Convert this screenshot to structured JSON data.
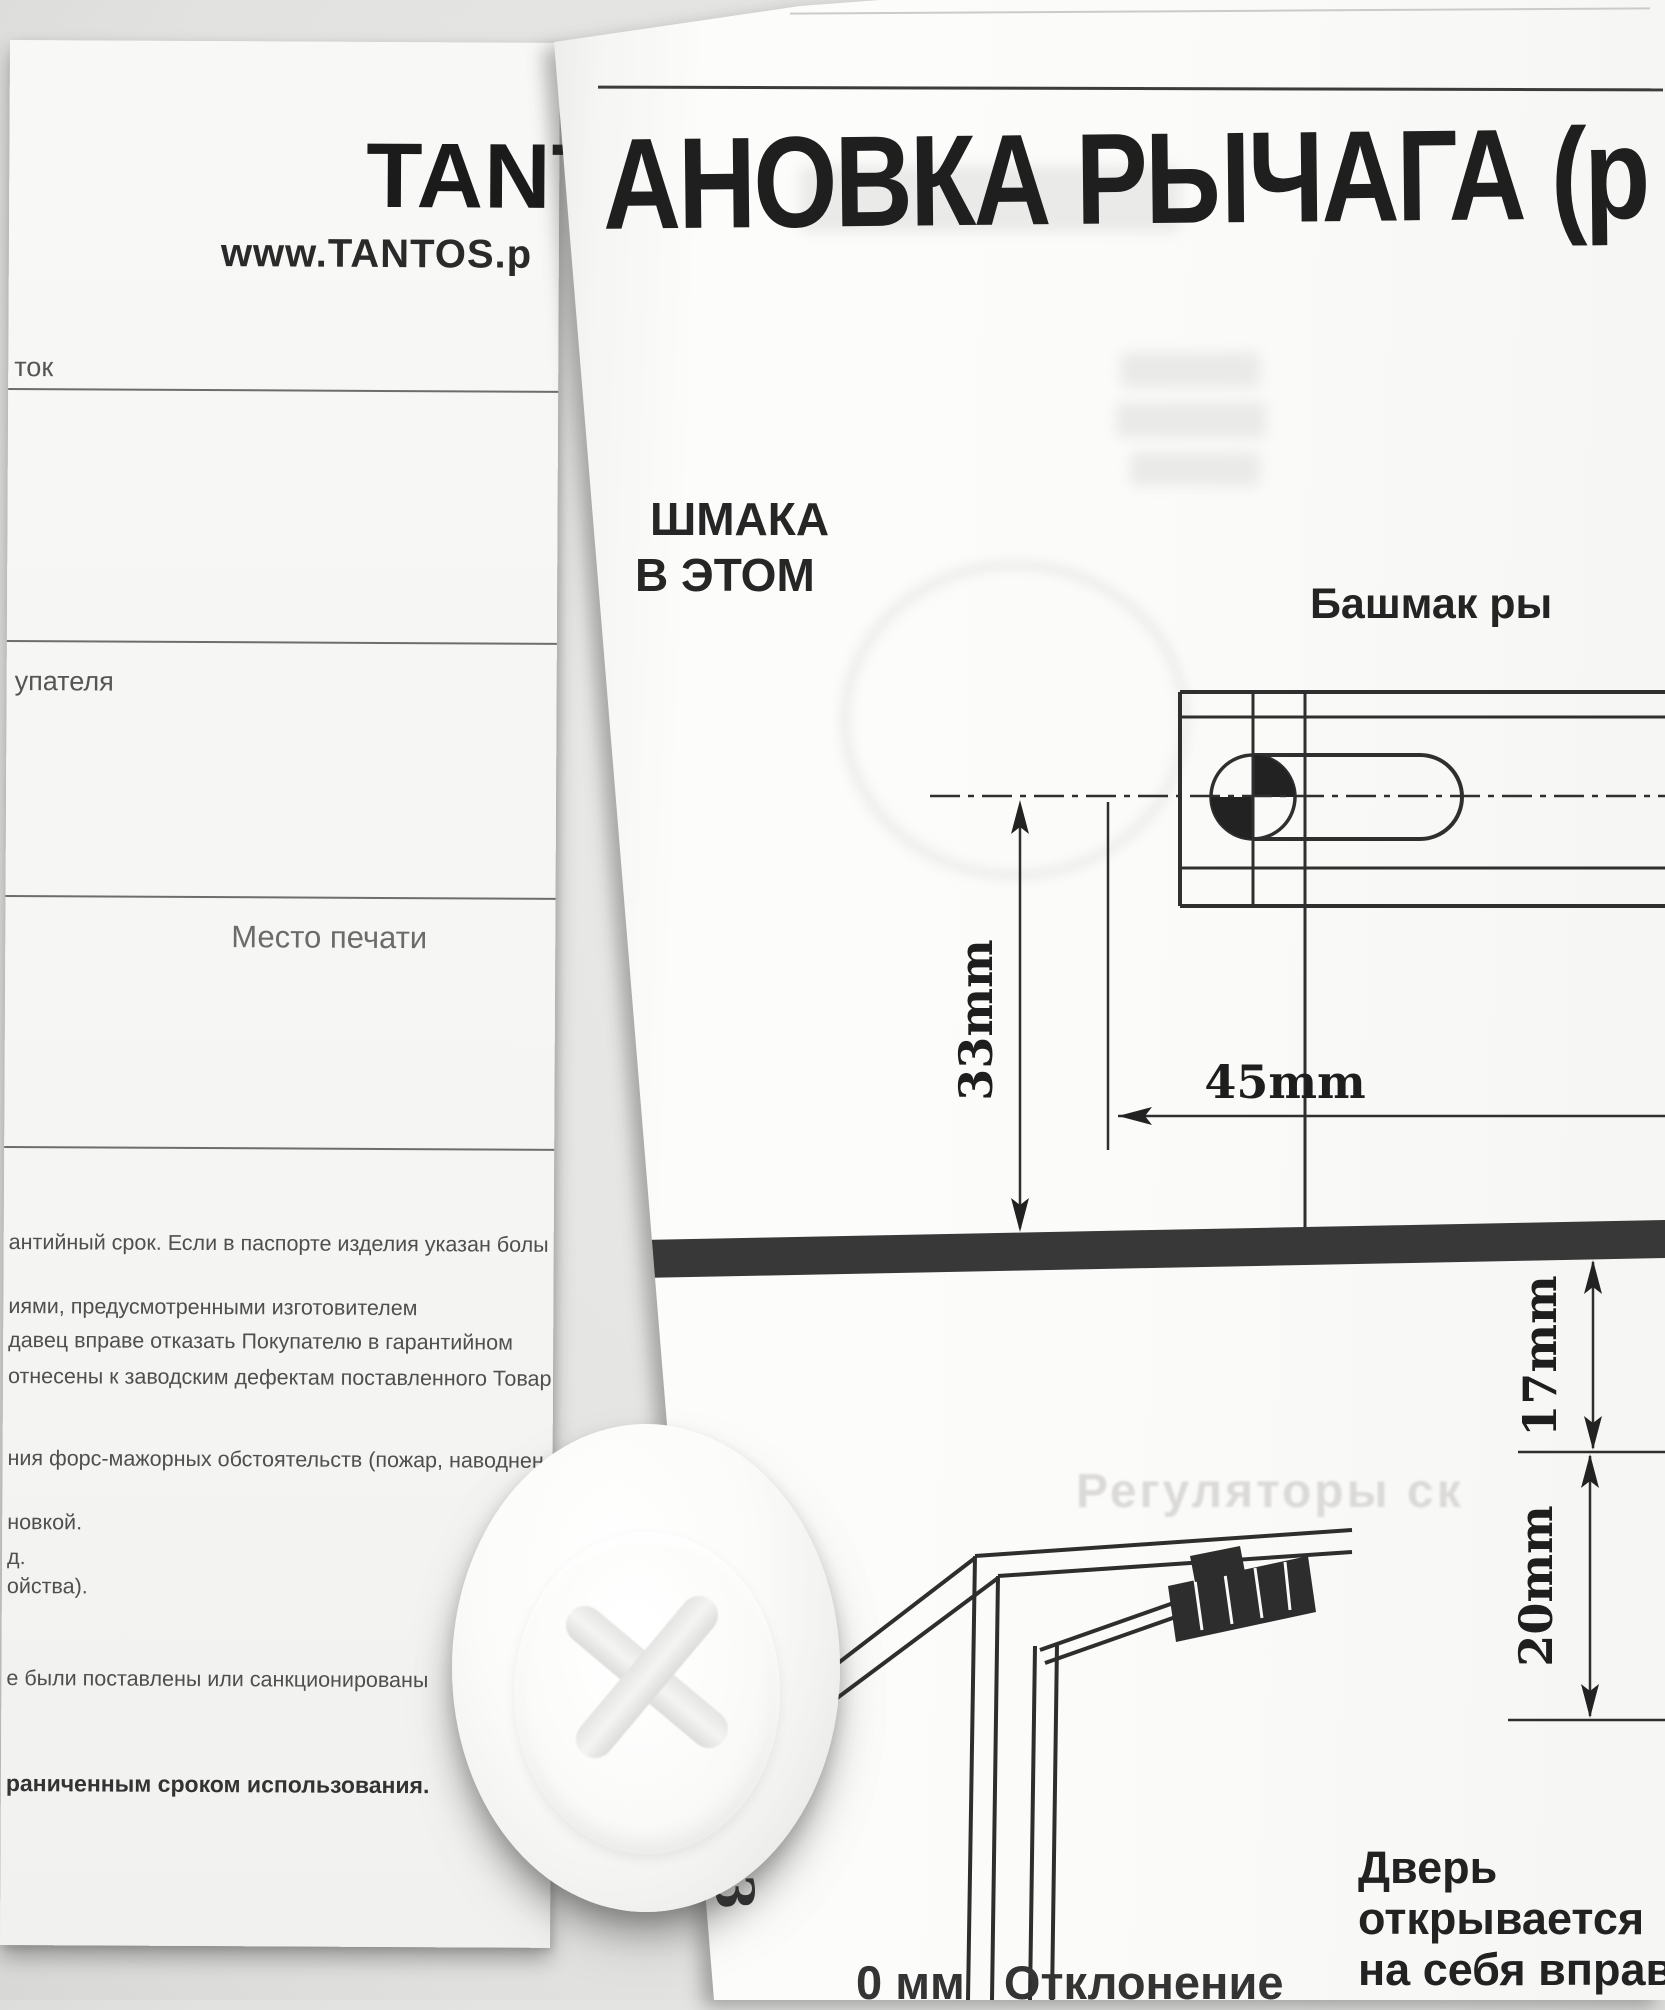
{
  "left_sheet": {
    "brand_fragment": "TANTO",
    "website_fragment": "www.TANTOS.p",
    "field_top_label": "ток",
    "buyer_label_fragment": "упателя",
    "stamp_placeholder": "Место печати",
    "terms": [
      "антийный срок. Если в паспорте изделия указан болы",
      "иями, предусмотренными изготовителем",
      "давец вправе отказать Покупателю в гарантийном",
      "отнесены к заводским дефектам поставленного Товар",
      "ния форс-мажорных обстоятельств (пожар, наводнен",
      "новкой.",
      "д.",
      "ойства).",
      "е были поставлены или санкционированы"
    ],
    "terms_bold": "раниченным сроком использования."
  },
  "right_sheet": {
    "title_fragment": "АНОВКА РЫЧАГА (р",
    "left_col_line1": "ШМАКА",
    "left_col_line2": "В ЭТОМ",
    "shoe_label_fragment": "Башмак ры",
    "dims": {
      "v33": "33mm",
      "h45": "45mm",
      "v17": "17mm",
      "v20": "20mm"
    },
    "ghost_fragment": "Регуляторы ск",
    "door_note": [
      "Дверь",
      "открывается",
      "на себя вправо"
    ],
    "bottom_cut_fragment": "0 мм   Отклонение",
    "edge_glyph": "3"
  },
  "colors": {
    "ink": "#1f1f1f",
    "divider_bar": "#383838",
    "paper": "#fbfbf9"
  }
}
